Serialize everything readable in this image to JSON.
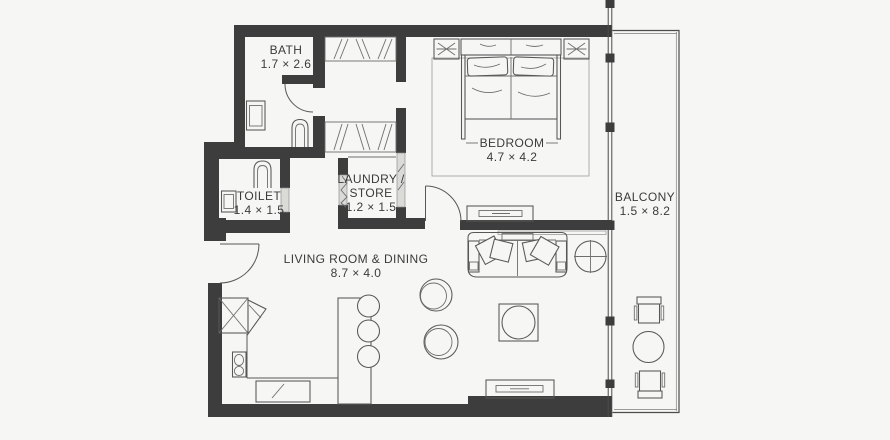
{
  "rooms": {
    "bath": {
      "name": "BATH",
      "dims": "1.7 × 2.6"
    },
    "toilet": {
      "name": "TOILET",
      "dims": "1.4 × 1.5"
    },
    "laundry_store": {
      "name_line1": "LAUNDRY /",
      "name_line2": "STORE",
      "dims": "1.2 × 1.5"
    },
    "bedroom": {
      "name": "BEDROOM",
      "dims": "4.7 × 4.2"
    },
    "living_dining": {
      "name": "LIVING ROOM & DINING",
      "dims": "8.7 × 4.0"
    },
    "balcony": {
      "name": "BALCONY",
      "dims": "1.5 × 8.2"
    }
  },
  "symbols": {
    "bedroom": [
      "double-bed",
      "pillows",
      "nightstand-lamp-left",
      "nightstand-lamp-right",
      "rug",
      "tv-console"
    ],
    "living_dining": [
      "sofa-with-cushions",
      "wall-shelf",
      "round-side-table",
      "coffee-table",
      "pouf-1",
      "pouf-2",
      "media-unit"
    ],
    "kitchen": [
      "refrigerator",
      "corner-cabinet",
      "sink-counter",
      "cooktop",
      "island-counter",
      "bar-stool-1",
      "bar-stool-2",
      "bar-stool-3"
    ],
    "bath": [
      "washbasin",
      "wc"
    ],
    "toilet": [
      "wc",
      "washbasin"
    ],
    "storage": [
      "wardrobe-top",
      "wardrobe-bottom",
      "laundry-sliding-door",
      "toilet-sliding-door"
    ],
    "balcony": [
      "outdoor-chair-top",
      "round-table",
      "outdoor-chair-bottom"
    ],
    "doors": [
      "entry-door",
      "bath-door",
      "bedroom-door"
    ]
  },
  "colors": {
    "wall": "#3d3d3d",
    "line": "#575757",
    "light_line": "#9c9c9c",
    "slider_fill": "#dadad7",
    "background": "#f6f6f4",
    "text": "#3b3b3b"
  }
}
